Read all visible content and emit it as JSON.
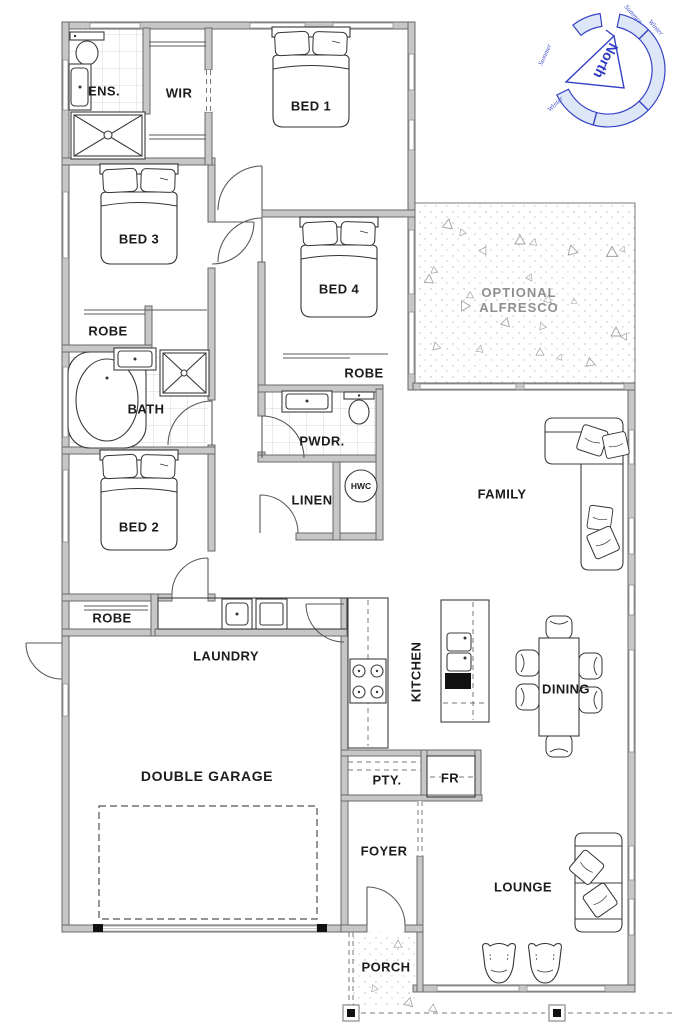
{
  "rooms": {
    "ens": "ENS.",
    "wir": "WIR",
    "bed1": "BED 1",
    "bed2": "BED 2",
    "bed3": "BED 3",
    "bed4": "BED 4",
    "robe": "ROBE",
    "bath": "BATH",
    "pwdr": "PWDR.",
    "linen": "LINEN",
    "hwc": "HWC",
    "family": "FAMILY",
    "alfresco_line1": "OPTIONAL",
    "alfresco_line2": "ALFRESCO",
    "kitchen": "KITCHEN",
    "dining": "DINING",
    "laundry": "LAUNDRY",
    "garage": "DOUBLE GARAGE",
    "pantry": "PTY.",
    "fridge": "FR",
    "foyer": "FOYER",
    "lounge": "LOUNGE",
    "porch": "PORCH"
  },
  "compass": {
    "north": "North",
    "winter": "Winter",
    "summer": "Summer"
  },
  "colors": {
    "wall_fill": "#c7c7c7",
    "wall_edge": "#6a6a6a",
    "fixture_line": "#3c3c3c",
    "alfresco_text": "#8f8f8f",
    "compass_blue": "#3642c6"
  }
}
